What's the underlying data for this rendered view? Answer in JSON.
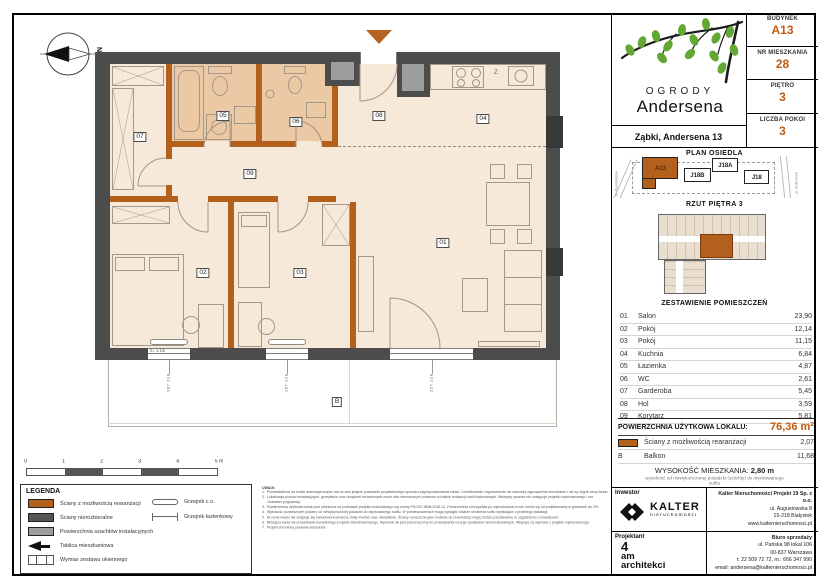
{
  "colors": {
    "accent": "#c05a11",
    "wall_dark": "#4c4c4c",
    "wall_orange": "#b2601c",
    "shaft_gray": "#9d9d9d",
    "floor": "#f7e9da",
    "floor_tan": "#ebc9a4"
  },
  "header": {
    "logo_line1": "OGRODY",
    "logo_line2": "Andersena",
    "address": "Ząbki, Andersena 13",
    "info": [
      {
        "label": "BUDYNEK",
        "value": "A13"
      },
      {
        "label": "NR MIESZKANIA",
        "value": "28"
      },
      {
        "label": "PIĘTRO",
        "value": "3"
      },
      {
        "label": "LICZBA POKOI",
        "value": "3"
      }
    ]
  },
  "site_plan": {
    "title": "PLAN OSIEDLA",
    "buildings": [
      {
        "name": "A13",
        "highlight": true
      },
      {
        "name": "J18B",
        "highlight": false
      },
      {
        "name": "J18A",
        "highlight": false
      },
      {
        "name": "J18",
        "highlight": false
      }
    ],
    "street_left": "ul. Powstańców",
    "street_right": "ul. Andersena"
  },
  "floor_overview": {
    "title": "RZUT PIĘTRA 3"
  },
  "rooms_table": {
    "title": "ZESTAWIENIE POMIESZCZEŃ",
    "rows": [
      {
        "no": "01",
        "name": "Salon",
        "area": "23,90"
      },
      {
        "no": "02",
        "name": "Pokój",
        "area": "12,14"
      },
      {
        "no": "03",
        "name": "Pokój",
        "area": "11,15"
      },
      {
        "no": "04",
        "name": "Kuchnia",
        "area": "6,84"
      },
      {
        "no": "05",
        "name": "Łazienka",
        "area": "4,87"
      },
      {
        "no": "06",
        "name": "WC",
        "area": "2,61"
      },
      {
        "no": "07",
        "name": "Garderoba",
        "area": "5,45"
      },
      {
        "no": "08",
        "name": "Hol",
        "area": "3,59"
      },
      {
        "no": "09",
        "name": "Korytarz",
        "area": "5,81"
      }
    ],
    "total_label": "POWIERZCHNIA UŻYTKOWA LOKALU:",
    "total_value": "76,36 m²",
    "walls_row": {
      "name": "Ściany z możliwością rearanżacji",
      "value": "2,07"
    },
    "balcony_row": {
      "no": "B",
      "name": "Balkon",
      "value": "11,68"
    },
    "height_label": "WYSOKOŚĆ MIESZKANIA:",
    "height_value": "2,80 m",
    "height_note": "wysokość od niewykończonej posadzki (szlichty) do otynkowanego sufitu"
  },
  "plan": {
    "compass": "N",
    "kitchen_label": "Z",
    "balcony_label": "B",
    "window_note": "h= 1,1m",
    "room_labels": [
      {
        "no": "01",
        "x": 443,
        "y": 243
      },
      {
        "no": "02",
        "x": 203,
        "y": 273
      },
      {
        "no": "03",
        "x": 300,
        "y": 273
      },
      {
        "no": "04",
        "x": 483,
        "y": 119
      },
      {
        "no": "05",
        "x": 223,
        "y": 116
      },
      {
        "no": "06",
        "x": 296,
        "y": 122
      },
      {
        "no": "07",
        "x": 140,
        "y": 137
      },
      {
        "no": "08",
        "x": 379,
        "y": 116
      },
      {
        "no": "09",
        "x": 250,
        "y": 174
      }
    ],
    "window_dims": [
      {
        "text": "167 218",
        "x": 169
      },
      {
        "text": "167 218",
        "x": 287
      },
      {
        "text": "227 218",
        "x": 432
      }
    ]
  },
  "scale_bar": {
    "ticks": [
      "0",
      "1",
      "2",
      "3",
      "4",
      "5 m"
    ]
  },
  "legend": {
    "title": "LEGENDA",
    "items_left": [
      {
        "icon": "swatch-orange",
        "label": "Ściany z możliwością rearanżacji"
      },
      {
        "icon": "swatch-dark",
        "label": "Ściany nierozbieralne"
      },
      {
        "icon": "swatch-gray",
        "label": "Powierzchnia szachtów instalacyjnych"
      },
      {
        "icon": "arrow",
        "label": "Tablica mieszkaniowa"
      },
      {
        "icon": "window",
        "label": "Wymiar zestawu okiennego"
      }
    ],
    "items_right": [
      {
        "icon": "radiator-co",
        "label": "Grzejnik c.o."
      },
      {
        "icon": "radiator-bath",
        "label": "Grzejnik łazienkowy"
      }
    ]
  },
  "notes": {
    "title": "UWAGI:",
    "items": [
      "Przedstawiona na rzucie aranżacja wnętrz ma na celu jedynie pokazanie przykładowego sposobu zagospodarowania lokalu. Umeblowanie i wyposażenie nie stanowią wyposażenia mieszkania i nie są objęte ceną lokalu.",
      "Lokalizacja pionów instalacyjnych, grzejników oraz urządzeń technicznych może ulec nieznacznym zmianom w trakcie realizacji robót budowlanych. Niniejszy rysunek nie zastępuje projektu wykonawczego i ma charakter poglądowy.",
      "Powierzchnia użytkowa lokalu jest określona na podstawie projektu budowlanego wg normy PN-ISO 9836:2015-12. Powierzchnia rzeczywista po wybudowaniu może różnić się od projektowanej w granicach do 2%.",
      "Wysokość pomieszczeń podano od niewykończonej posadzki do otynkowanego sufitu. W pomieszczeniach mogą wystąpić lokalne obniżenia sufitu wynikające z przebiegu instalacji.",
      "W cenie lokalu nie znajduje się zabudowa kuchenna, biały montaż oraz oświetlenie. Ściany oznaczone jako możliwe do rearanżacji mogą zostać przestawione w uzgodnieniu z inwestorem.",
      "Niniejsza karta nie przedstawia kompletnego projektu wielobranżowego. Rysunek nie jest przeznaczony do prowadzenia na jego podstawie robót budowlanych. Wiążące są wymiary z projektu wykonawczego.",
      "Projekt chroniony prawami autorskimi."
    ]
  },
  "footer": {
    "investor_label": "Inwestor",
    "investor_brand": "KALTER",
    "investor_brand_sub": "nieruchomości",
    "company_name": "Kalter Nieruchomości Projekt 19 Sp. z o.o.",
    "company_lines": [
      "ul. Augustowska 8",
      "15-218 Białystok",
      "www.kalternieruchomosci.pl"
    ],
    "designer_label": "Projektant",
    "designer_lines": [
      "4",
      "am",
      "architekci"
    ],
    "sales_label": "Biuro sprzedaży",
    "sales_lines": [
      "ul. Pańska 98 lokal 106",
      "00-837 Warszawa",
      "t: 22 509 72 72, m.: 666 347 990",
      "email: andersena@kalternieruchomosci.pl"
    ]
  }
}
